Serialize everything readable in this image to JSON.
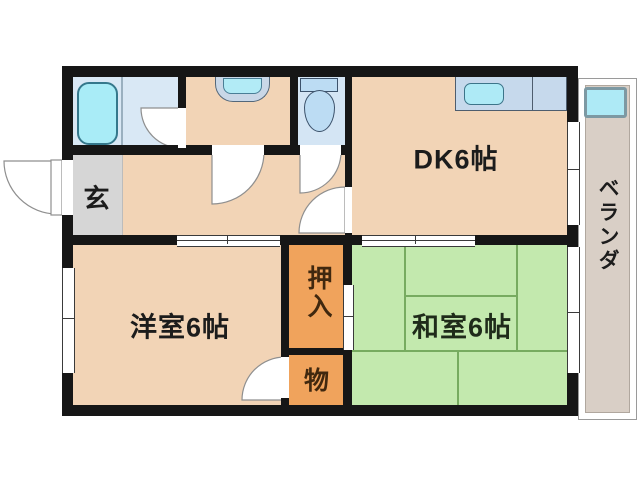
{
  "plan": {
    "title": "apartment-floor-plan",
    "rooms": {
      "entrance": {
        "label": "玄"
      },
      "dining_kitchen": {
        "label": "DK6帖"
      },
      "western_room": {
        "label": "洋室6帖"
      },
      "japanese_room": {
        "label": "和室6帖"
      },
      "closet": {
        "label": "押入"
      },
      "storage": {
        "label": "物"
      },
      "veranda": {
        "label": "ベランダ"
      }
    },
    "fixtures": [
      {
        "name": "bathtub-icon"
      },
      {
        "name": "vanity-sink-icon"
      },
      {
        "name": "toilet-icon"
      },
      {
        "name": "kitchen-sink-icon"
      },
      {
        "name": "washing-machine-pan-icon"
      }
    ],
    "colors": {
      "wall": "#161616",
      "room_peach": "#f2d4b6",
      "closet_orange": "#f0a35c",
      "tatami_green": "#c3e9ae",
      "tatami_line": "#77ab60",
      "water_cyan": "#aeeaf6",
      "bath_floor_blue": "#d9e8f5",
      "counter_blue": "#c6d9ec",
      "entrance_gray": "#d6d6d6",
      "veranda_tan": "#d9cfc6"
    }
  }
}
